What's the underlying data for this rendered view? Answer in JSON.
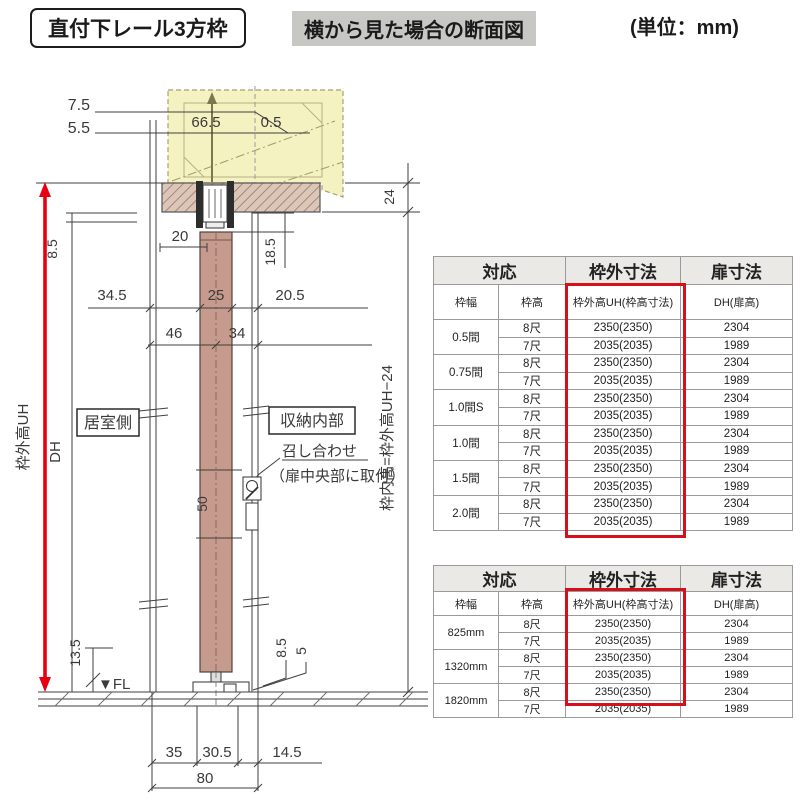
{
  "header": {
    "title": "直付下レール3方枠",
    "subtitle": "横から見た場合の断面図",
    "unit": "(単位：mm)"
  },
  "drawing": {
    "labels": {
      "room_side": "居室側",
      "closet_side": "収納内部",
      "meeting": "召し合わせ",
      "meeting_note": "（扉中央部に取付）",
      "fl": "▼FL",
      "uh_label": "枠外高UH",
      "dh_label": "DH",
      "inner_label": "枠内高=枠外高UH−24"
    },
    "dims": {
      "offset_a": "7.5",
      "offset_b": "5.5",
      "pocket_a": "66.5",
      "pocket_b": "0.5",
      "rail_w": "20",
      "header_h": "24",
      "hanger_h": "18.5",
      "top_gap": "8.5",
      "front_a": "34.5",
      "door_t": "25",
      "back_a": "20.5",
      "front_c": "46",
      "back_c": "34",
      "meet_h": "50",
      "floor_a": "13.5",
      "guide_h": "8.5",
      "guide_lip": "5",
      "bot_a": "35",
      "bot_b": "30.5",
      "bot_c": "14.5",
      "bot_total": "80"
    },
    "accent_color": "#e60012"
  },
  "table1": {
    "col_headers": {
      "taiou": "対応",
      "wakugai": "枠外寸法",
      "tobira": "扉寸法",
      "wakuhaba": "枠幅",
      "wakudaka": "枠高",
      "uh": "枠外高UH(枠高寸法)",
      "dh": "DH(扉高)"
    },
    "groups": [
      {
        "label": "0.5間",
        "rows": [
          [
            "8尺",
            "2350(2350)",
            "2304"
          ],
          [
            "7尺",
            "2035(2035)",
            "1989"
          ]
        ]
      },
      {
        "label": "0.75間",
        "rows": [
          [
            "8尺",
            "2350(2350)",
            "2304"
          ],
          [
            "7尺",
            "2035(2035)",
            "1989"
          ]
        ]
      },
      {
        "label": "1.0間S",
        "rows": [
          [
            "8尺",
            "2350(2350)",
            "2304"
          ],
          [
            "7尺",
            "2035(2035)",
            "1989"
          ]
        ]
      },
      {
        "label": "1.0間",
        "rows": [
          [
            "8尺",
            "2350(2350)",
            "2304"
          ],
          [
            "7尺",
            "2035(2035)",
            "1989"
          ]
        ]
      },
      {
        "label": "1.5間",
        "rows": [
          [
            "8尺",
            "2350(2350)",
            "2304"
          ],
          [
            "7尺",
            "2035(2035)",
            "1989"
          ]
        ]
      },
      {
        "label": "2.0間",
        "rows": [
          [
            "8尺",
            "2350(2350)",
            "2304"
          ],
          [
            "7尺",
            "2035(2035)",
            "1989"
          ]
        ]
      }
    ]
  },
  "table2": {
    "col_headers": {
      "taiou": "対応",
      "wakugai": "枠外寸法",
      "tobira": "扉寸法",
      "wakuhaba": "枠幅",
      "wakudaka": "枠高",
      "uh": "枠外高UH(枠高寸法)",
      "dh": "DH(扉高)"
    },
    "groups": [
      {
        "label": "825mm",
        "rows": [
          [
            "8尺",
            "2350(2350)",
            "2304"
          ],
          [
            "7尺",
            "2035(2035)",
            "1989"
          ]
        ]
      },
      {
        "label": "1320mm",
        "rows": [
          [
            "8尺",
            "2350(2350)",
            "2304"
          ],
          [
            "7尺",
            "2035(2035)",
            "1989"
          ]
        ]
      },
      {
        "label": "1820mm",
        "rows": [
          [
            "8尺",
            "2350(2350)",
            "2304"
          ],
          [
            "7尺",
            "2035(2035)",
            "1989"
          ]
        ]
      }
    ]
  }
}
